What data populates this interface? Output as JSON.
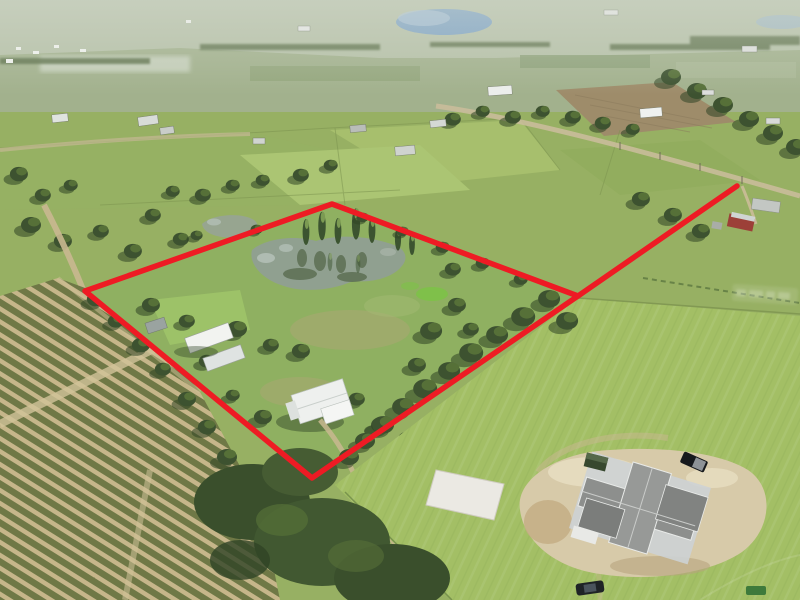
{
  "meta": {
    "kind": "aerial-drone-photo",
    "description": "Aerial photo of flat rural acreage; a red outline marks a roughly diamond-shaped parcel containing a pond, trees, a white-roof house and sheds; citrus grove rows lower-left; large mowed pasture and a new house under construction lower-right; scattered homesteads and hazy farmland to the horizon."
  },
  "overlay": {
    "boundary_color": "#ee1b24",
    "boundary_points": "332,204 578,296 312,478 85,291",
    "spur_path": "M578,296 L737,186",
    "stroke_width": "5.5"
  },
  "palette": {
    "haze": "#c6cfc0",
    "far_fields": "#a2b18d",
    "base_ground": "#97b063",
    "parcel_green": "#9cb468",
    "pasture": "#a3bf65",
    "property_grass": "#8fb061",
    "pond_water": "#90a090",
    "small_pond_water": "#97a590",
    "lake_blue": "#7ea3c4",
    "tree_dark": "#3d5230",
    "road_tan": "#c9b890",
    "grove_row_olive": "#6f7846",
    "grove_ground_tan": "#c6b68a",
    "tilled_brown": "#9e8c6a",
    "sand_dirt": "#d7caa9",
    "construction_roof": "#8d8f8d",
    "white_roof": "#eff1ee",
    "concrete_pad": "#ebe9e3",
    "algae_green": "#7fc04a",
    "red_barn": "#9c4038"
  },
  "features": {
    "outlined_property": "diamond-shaped parcel outlined in red",
    "road_spur": "red line from parcel corner to road at upper right",
    "pond": "large irregular pond with cypress trees",
    "small_pond": "small pond just outside north corner",
    "main_house": "white metal-roof house with driveway",
    "sheds": "white-roof outbuildings near west corner",
    "citrus_grove": "row-crop grove, lower left",
    "pasture": "large mowed pasture, right",
    "construction_site": "new home under construction on sand pad",
    "concrete_pad": "white slab left of construction",
    "lake": "blue lake on horizon",
    "watermark": "faint illegible watermark near right edge"
  }
}
